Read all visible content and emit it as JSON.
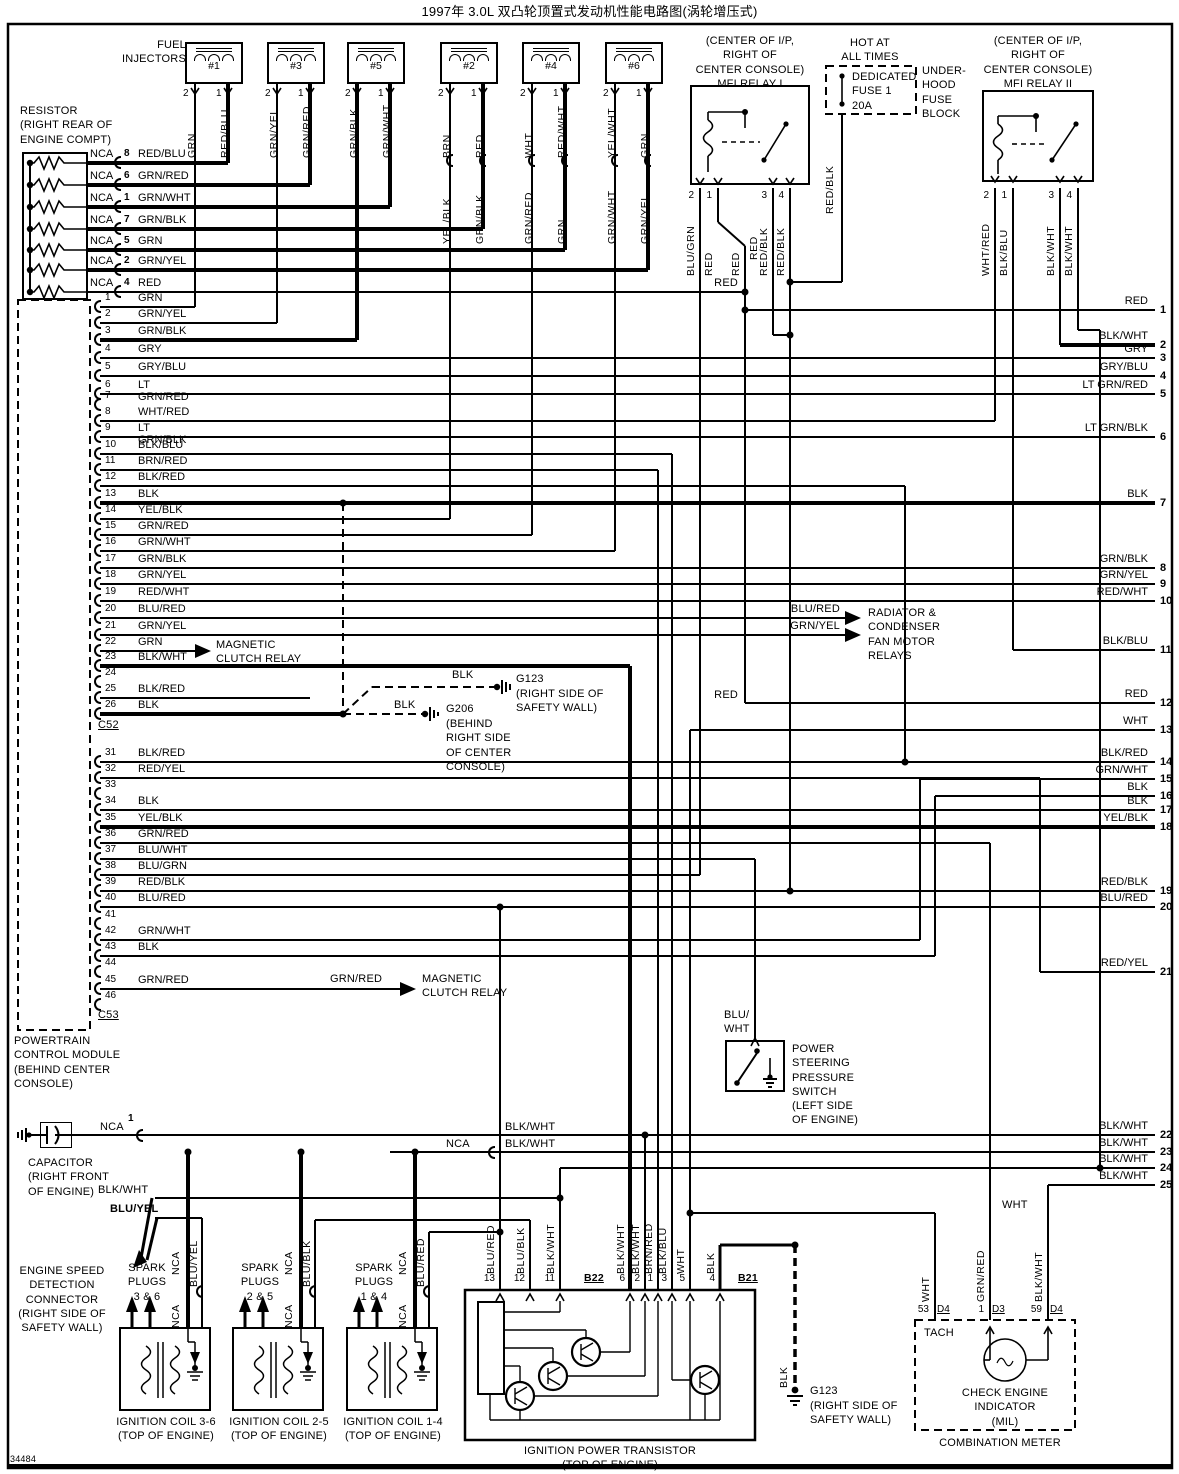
{
  "title": "1997年 3.0L 双凸轮顶置式发动机性能电路图(涡轮增压式)",
  "doc_number": "34484",
  "labels": {
    "red": "RED"
  },
  "fuel_injectors": {
    "label": "FUEL\nINJECTORS",
    "pin2": "2",
    "pin1": "1",
    "units": [
      {
        "name": "#1",
        "wire2": "GRN",
        "wire1": "RED/BLU",
        "lower2": "",
        "lower1": ""
      },
      {
        "name": "#3",
        "wire2": "GRN/YEL",
        "wire1": "GRN/RED",
        "lower2": "",
        "lower1": ""
      },
      {
        "name": "#5",
        "wire2": "GRN/BLK",
        "wire1": "GRN/WHT",
        "lower2": "",
        "lower1": ""
      },
      {
        "name": "#2",
        "wire2": "BRN",
        "wire1": "RED",
        "lower2": "YEL/BLK",
        "lower1": "GRN/BLK"
      },
      {
        "name": "#4",
        "wire2": "WHT",
        "wire1": "RED/WHT",
        "lower2": "GRN/RED",
        "lower1": "GRN"
      },
      {
        "name": "#6",
        "wire2": "YEL/WHT",
        "wire1": "GRN",
        "lower2": "GRN/WHT",
        "lower1": "GRN/YEL"
      }
    ]
  },
  "resistor": {
    "label": "RESISTOR\n(RIGHT REAR OF\nENGINE COMPT)",
    "rows": [
      {
        "nca": "NCA",
        "pin": "8",
        "wire": "RED/BLU"
      },
      {
        "nca": "NCA",
        "pin": "6",
        "wire": "GRN/RED"
      },
      {
        "nca": "NCA",
        "pin": "1",
        "wire": "GRN/WHT"
      },
      {
        "nca": "NCA",
        "pin": "7",
        "wire": "GRN/BLK"
      },
      {
        "nca": "NCA",
        "pin": "5",
        "wire": "GRN"
      },
      {
        "nca": "NCA",
        "pin": "2",
        "wire": "GRN/YEL"
      },
      {
        "nca": "NCA",
        "pin": "4",
        "wire": "RED"
      }
    ]
  },
  "mfi_relay_1": {
    "location": "(CENTER OF I/P,\nRIGHT OF\nCENTER CONSOLE)\nMFI RELAY I",
    "terminals": [
      {
        "pin": "2",
        "wire": "BLU/GRN"
      },
      {
        "pin": "1",
        "wire": "RED"
      },
      {
        "pin": "",
        "wire": "RED"
      },
      {
        "pin": "3",
        "wire": "RED/BLK"
      },
      {
        "pin": "4",
        "wire": "RED/BLK"
      }
    ]
  },
  "fuse_block": {
    "hot": "HOT AT\nALL TIMES",
    "fuse": "DEDICATED\nFUSE 1\n20A",
    "block": "UNDER-\nHOOD\nFUSE\nBLOCK",
    "wire": "RED/BLK"
  },
  "mfi_relay_2": {
    "location": "(CENTER OF I/P,\nRIGHT OF\nCENTER CONSOLE)\nMFI RELAY II",
    "terminals": [
      {
        "pin": "2",
        "wire": "WHT/RED"
      },
      {
        "pin": "1",
        "wire": "BLK/BLU"
      },
      {
        "pin": "3",
        "wire": "BLK/WHT"
      },
      {
        "pin": "4",
        "wire": "BLK/WHT"
      }
    ]
  },
  "pcm": {
    "label": "POWERTRAIN\nCONTROL MODULE\n(BEHIND CENTER\nCONSOLE)",
    "connector1": "C52",
    "connector2": "C53",
    "c52_pins": [
      {
        "pin": "1",
        "wire": "GRN"
      },
      {
        "pin": "2",
        "wire": "GRN/YEL"
      },
      {
        "pin": "3",
        "wire": "GRN/BLK"
      },
      {
        "pin": "4",
        "wire": "GRY"
      },
      {
        "pin": "5",
        "wire": "GRY/BLU"
      },
      {
        "pin": "6",
        "wire": "LT GRN/RED"
      },
      {
        "pin": "7",
        "wire": ""
      },
      {
        "pin": "8",
        "wire": "WHT/RED"
      },
      {
        "pin": "9",
        "wire": "LT GRN/BLK"
      },
      {
        "pin": "10",
        "wire": "BLK/BLU"
      },
      {
        "pin": "11",
        "wire": "BRN/RED"
      },
      {
        "pin": "12",
        "wire": "BLK/RED"
      },
      {
        "pin": "13",
        "wire": "BLK"
      },
      {
        "pin": "14",
        "wire": "YEL/BLK"
      },
      {
        "pin": "15",
        "wire": "GRN/RED"
      },
      {
        "pin": "16",
        "wire": "GRN/WHT"
      },
      {
        "pin": "17",
        "wire": "GRN/BLK"
      },
      {
        "pin": "18",
        "wire": "GRN/YEL"
      },
      {
        "pin": "19",
        "wire": "RED/WHT"
      },
      {
        "pin": "20",
        "wire": "BLU/RED"
      },
      {
        "pin": "21",
        "wire": "GRN/YEL"
      },
      {
        "pin": "22",
        "wire": "GRN"
      },
      {
        "pin": "23",
        "wire": "BLK/WHT"
      },
      {
        "pin": "24",
        "wire": ""
      },
      {
        "pin": "25",
        "wire": "BLK/RED"
      },
      {
        "pin": "26",
        "wire": "BLK"
      }
    ],
    "c53_pins": [
      {
        "pin": "31",
        "wire": "BLK/RED"
      },
      {
        "pin": "32",
        "wire": "RED/YEL"
      },
      {
        "pin": "33",
        "wire": ""
      },
      {
        "pin": "34",
        "wire": "BLK"
      },
      {
        "pin": "35",
        "wire": "YEL/BLK"
      },
      {
        "pin": "36",
        "wire": "GRN/RED"
      },
      {
        "pin": "37",
        "wire": "BLU/WHT"
      },
      {
        "pin": "38",
        "wire": "BLU/GRN"
      },
      {
        "pin": "39",
        "wire": "RED/BLK"
      },
      {
        "pin": "40",
        "wire": "BLU/RED"
      },
      {
        "pin": "41",
        "wire": ""
      },
      {
        "pin": "42",
        "wire": "GRN/WHT"
      },
      {
        "pin": "43",
        "wire": "BLK"
      },
      {
        "pin": "44",
        "wire": ""
      },
      {
        "pin": "45",
        "wire": "GRN/RED"
      },
      {
        "pin": "46",
        "wire": ""
      }
    ]
  },
  "right_edge": [
    {
      "num": "1",
      "wire": "RED"
    },
    {
      "num": "2",
      "wire": "BLK/WHT"
    },
    {
      "num": "3",
      "wire": "GRY"
    },
    {
      "num": "4",
      "wire": "GRY/BLU"
    },
    {
      "num": "5",
      "wire": "LT GRN/RED"
    },
    {
      "num": "6",
      "wire": "LT GRN/BLK"
    },
    {
      "num": "7",
      "wire": "BLK"
    },
    {
      "num": "8",
      "wire": "GRN/BLK"
    },
    {
      "num": "9",
      "wire": "GRN/YEL"
    },
    {
      "num": "10",
      "wire": "RED/WHT"
    },
    {
      "num": "11",
      "wire": "BLK/BLU"
    },
    {
      "num": "12",
      "wire": "RED"
    },
    {
      "num": "13",
      "wire": "WHT"
    },
    {
      "num": "14",
      "wire": "BLK/RED"
    },
    {
      "num": "15",
      "wire": "GRN/WHT"
    },
    {
      "num": "16",
      "wire": "BLK"
    },
    {
      "num": "17",
      "wire": "BLK"
    },
    {
      "num": "18",
      "wire": "YEL/BLK"
    },
    {
      "num": "19",
      "wire": "RED/BLK"
    },
    {
      "num": "20",
      "wire": "BLU/RED"
    },
    {
      "num": "21",
      "wire": "RED/YEL"
    },
    {
      "num": "22",
      "wire": "BLK/WHT"
    },
    {
      "num": "23",
      "wire": "BLK/WHT"
    },
    {
      "num": "24",
      "wire": "BLK/WHT"
    },
    {
      "num": "25",
      "wire": "BLK/WHT"
    }
  ],
  "magnetic_clutch": {
    "label1": "MAGNETIC\nCLUTCH RELAY",
    "wire2": "GRN/RED",
    "label2": "MAGNETIC\nCLUTCH RELAY"
  },
  "fan_relays": {
    "wire_top": "BLU/RED",
    "wire_bottom": "GRN/YEL",
    "label": "RADIATOR &\nCONDENSER\nFAN MOTOR\nRELAYS"
  },
  "grounds": {
    "g123_mid": {
      "name": "G123",
      "loc": "(RIGHT SIDE OF\nSAFETY WALL)",
      "wire": "BLK"
    },
    "g206": {
      "name": "G206",
      "loc": "(BEHIND\nRIGHT SIDE\nOF CENTER\nCONSOLE)",
      "wire": "BLK"
    },
    "g123_bottom": {
      "name": "G123",
      "loc": "(RIGHT SIDE OF\nSAFETY WALL)",
      "wire": "BLK"
    }
  },
  "power_steering": {
    "wire": "BLU/\nWHT",
    "label": "POWER\nSTEERING\nPRESSURE\nSWITCH\n(LEFT SIDE\nOF ENGINE)"
  },
  "capacitor": {
    "nca": "NCA",
    "pin": "1",
    "label": "CAPACITOR\n(RIGHT FRONT\nOF ENGINE)"
  },
  "engine_speed": {
    "label": "ENGINE SPEED\nDETECTION\nCONNECTOR\n(RIGHT SIDE OF\nSAFETY WALL)",
    "wire_top": "BLK/WHT",
    "wire_bottom": "BLU/YEL"
  },
  "bottom_nets": {
    "row22": "BLK/WHT",
    "row23_nca": "NCA",
    "row23": "BLK/WHT",
    "wht": "WHT"
  },
  "coils": [
    {
      "plugs": "SPARK\nPLUGS\n3 & 6",
      "nca": "NCA",
      "feed": "BLU/YEL",
      "label": "IGNITION COIL 3-6\n(TOP OF ENGINE)"
    },
    {
      "plugs": "SPARK\nPLUGS\n2 & 5",
      "nca": "NCA",
      "feed": "BLU/BLK",
      "label": "IGNITION COIL 2-5\n(TOP OF ENGINE)"
    },
    {
      "plugs": "SPARK\nPLUGS\n1 & 4",
      "nca": "NCA",
      "feed": "BLU/RED",
      "label": "IGNITION COIL 1-4\n(TOP OF ENGINE)"
    }
  ],
  "power_transistor": {
    "label": "IGNITION POWER TRANSISTOR\n(TOP OF ENGINE)",
    "b22": "B22",
    "b21": "B21",
    "terminals": [
      {
        "pin": "13",
        "wire": "BLU/RED"
      },
      {
        "pin": "12",
        "wire": "BLU/BLK"
      },
      {
        "pin": "11",
        "wire": "BLK/WHT"
      },
      {
        "pin": "6",
        "wire": "BLK/WHT"
      },
      {
        "pin": "2",
        "wire": "BLK/WHT"
      },
      {
        "pin": "1",
        "wire": "BRN/RED"
      },
      {
        "pin": "3",
        "wire": "BLK/BLU"
      },
      {
        "pin": "5",
        "wire": "WHT"
      },
      {
        "pin": "4",
        "wire": "BLK"
      }
    ]
  },
  "combination_meter": {
    "label": "COMBINATION METER",
    "tach": "TACH",
    "mil": "CHECK ENGINE\nINDICATOR\n(MIL)",
    "terminals": [
      {
        "pin": "53",
        "conn": "D4",
        "wire": "WHT"
      },
      {
        "pin": "1",
        "conn": "D3",
        "wire": "GRN/RED"
      },
      {
        "pin": "59",
        "conn": "D4",
        "wire": "BLK/WHT"
      }
    ]
  }
}
